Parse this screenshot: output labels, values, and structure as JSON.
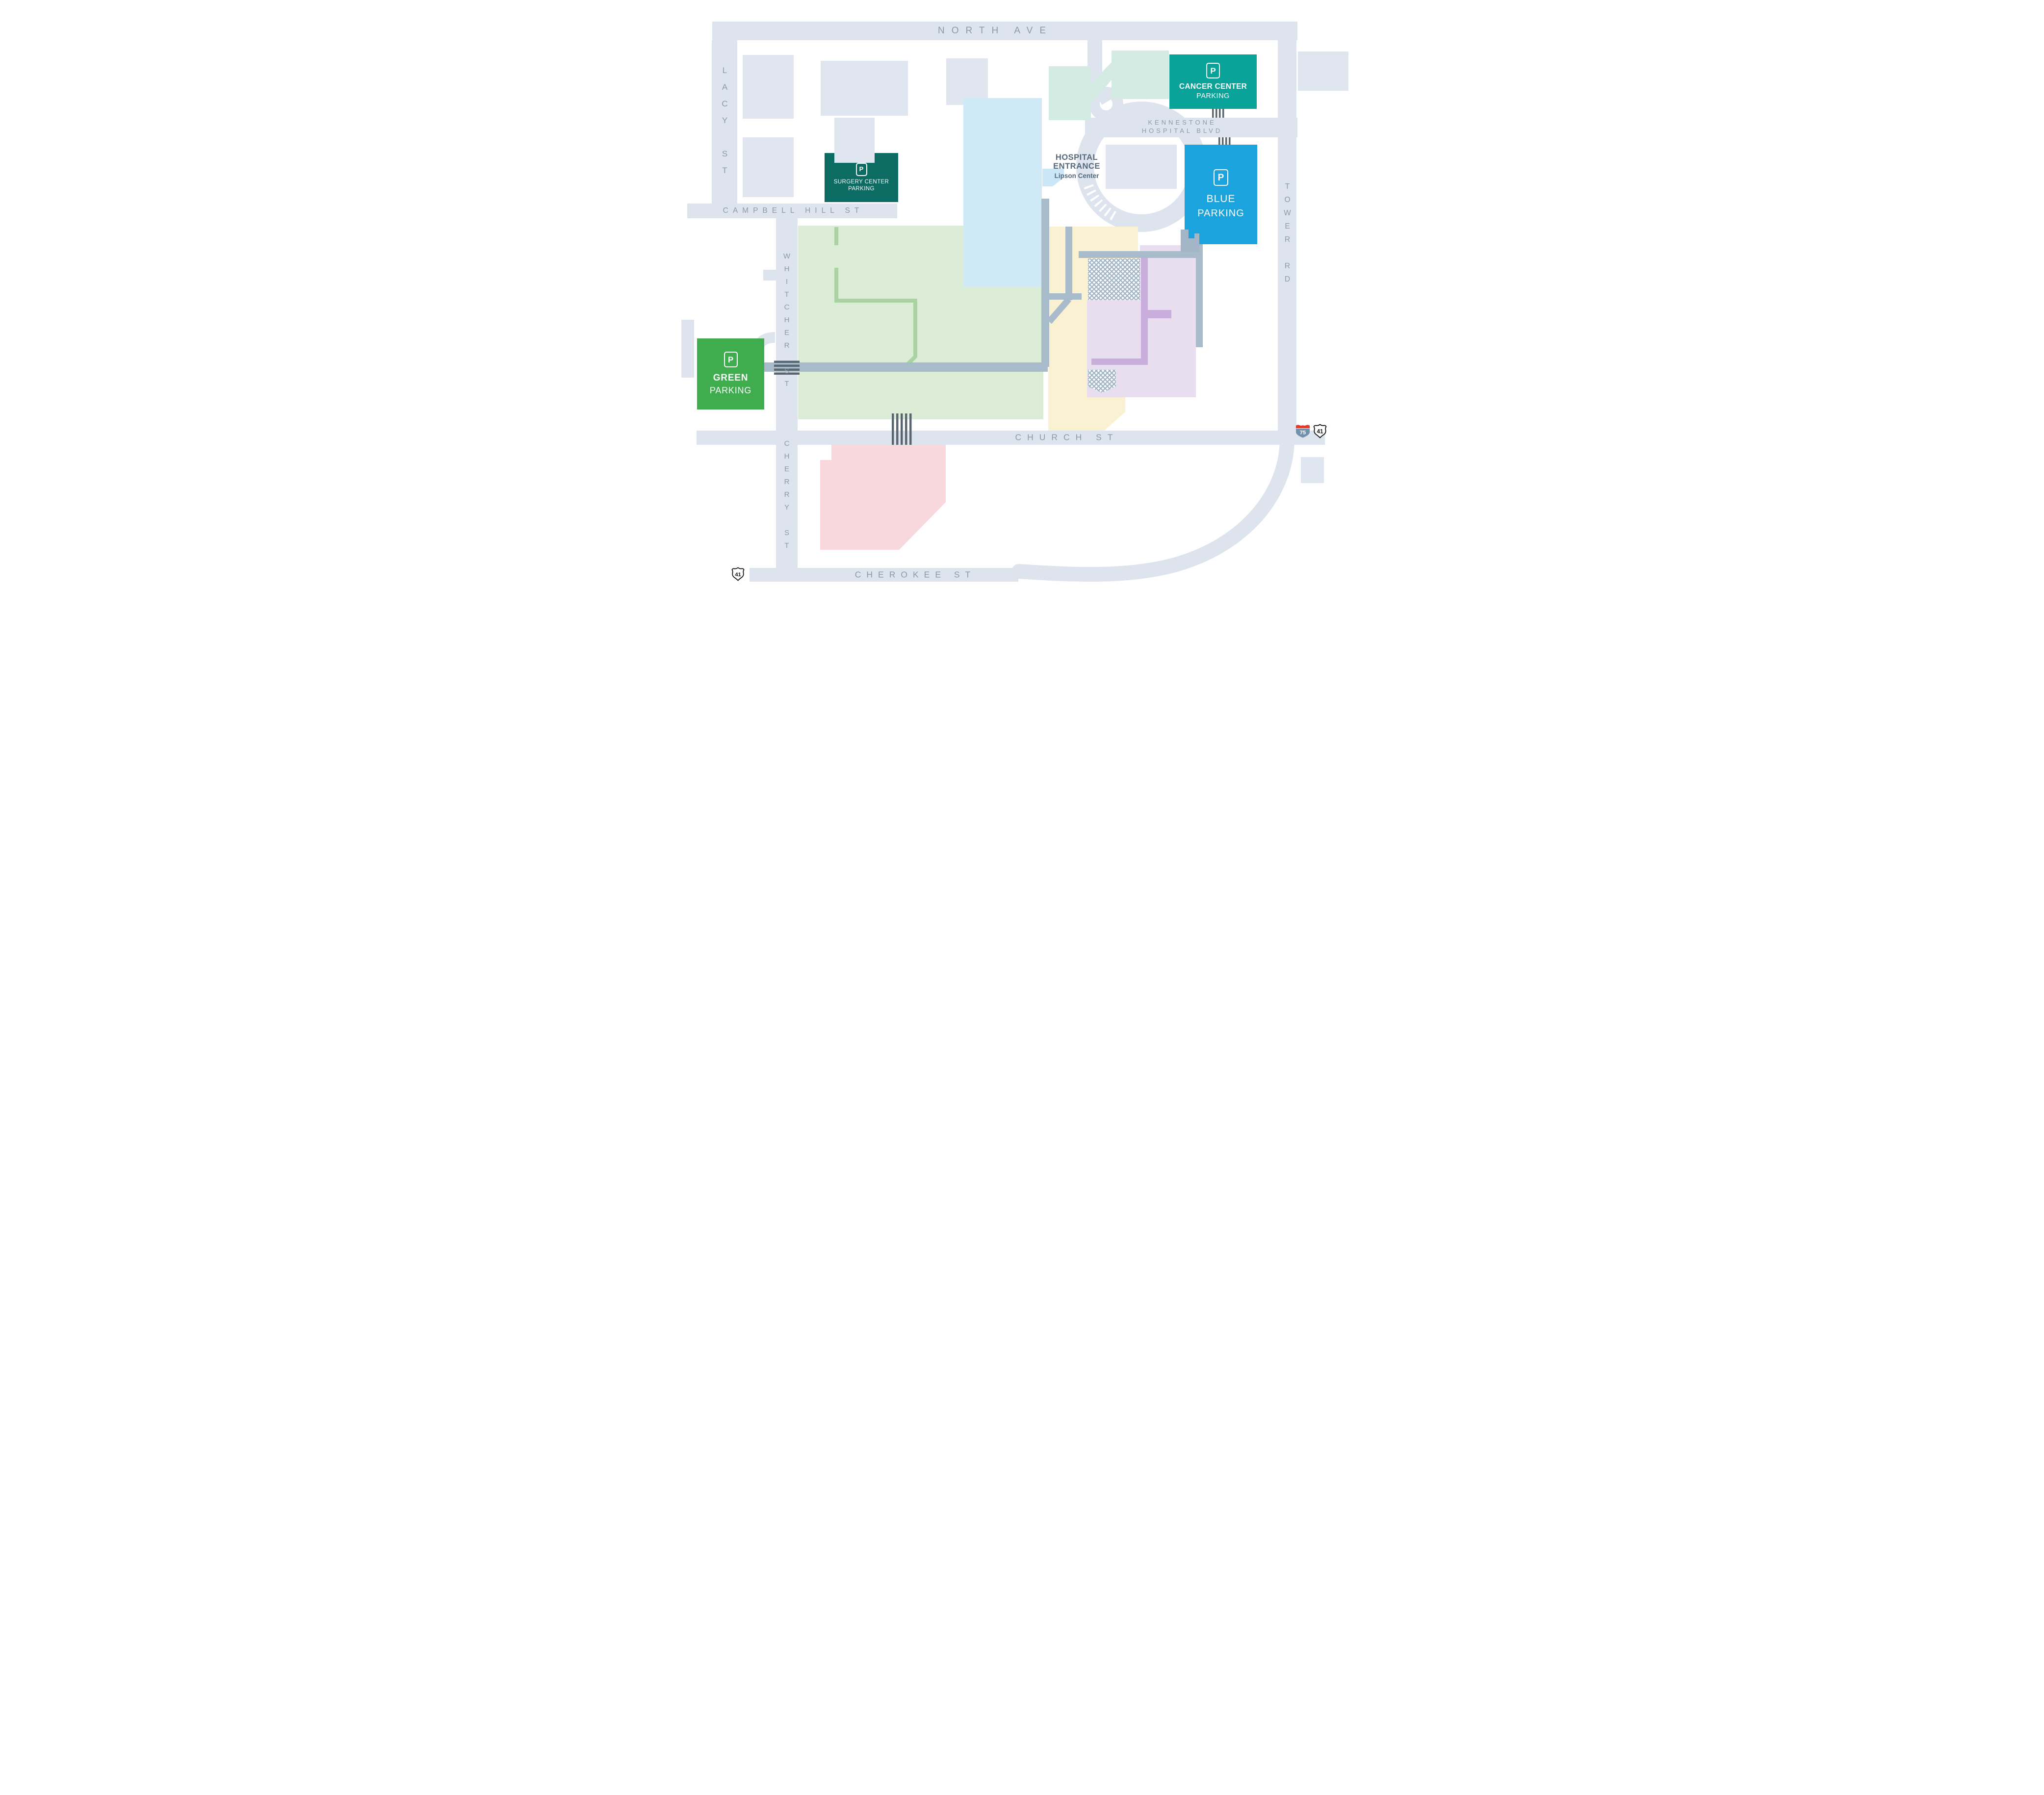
{
  "streets": {
    "north_ave": "NORTH AVE",
    "lacy": "LACY ST",
    "campbell": "CAMPBELL HILL ST",
    "whitcher": "WHITCHER ST",
    "cherry": "CHERRY ST",
    "church": "CHURCH ST",
    "cherokee": "CHEROKEE ST",
    "tower": "TOWER RD",
    "blvd_line1": "KENNESTONE",
    "blvd_line2": "HOSPITAL BLVD"
  },
  "entrance": {
    "line1": "HOSPITAL",
    "line2": "ENTRANCE",
    "line3": "Lipson Center"
  },
  "parking": {
    "p_symbol": "P",
    "cancer": {
      "line1": "CANCER CENTER",
      "line2": "PARKING",
      "color": "#0aa39a"
    },
    "surgery": {
      "line1": "SURGERY CENTER",
      "line2": "PARKING",
      "color": "#0c6b62"
    },
    "blue": {
      "line1": "BLUE",
      "line2": "PARKING",
      "color": "#1aa3dd"
    },
    "green": {
      "line1": "GREEN",
      "line2": "PARKING",
      "color": "#3fad4e"
    }
  },
  "shields": {
    "i75": "75",
    "us41": "41",
    "us41_sw": "41"
  },
  "colors": {
    "road": "#dde4ed",
    "road_label": "#8b9aa9",
    "building": "#dfe6ef",
    "walkway": "#a8bbca",
    "crosswalk": "#59666f",
    "mint": "#d4ebe4",
    "light_blue": "#cfe9f7",
    "pale_green": "#dcedd7",
    "green_path": "#a9d4a2",
    "cream": "#faf1d2",
    "lavender": "#e8def0",
    "purple": "#c9aedb",
    "pink": "#f8d8dc",
    "i75_red": "#e23a2c",
    "i75_blue": "#7291ad",
    "entrance_text": "#56697a"
  }
}
